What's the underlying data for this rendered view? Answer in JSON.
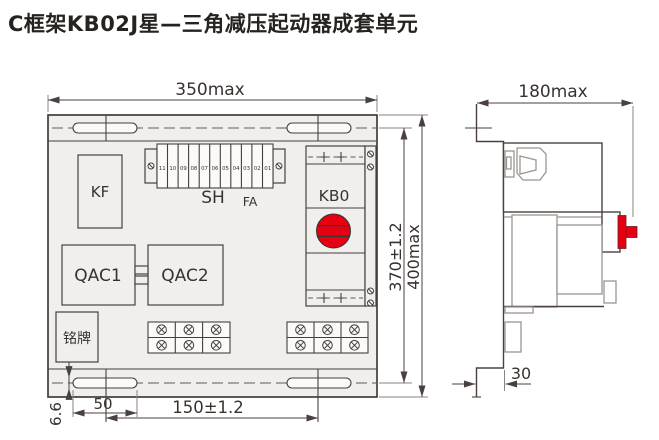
{
  "title": "C框架KB02J星—三角减压起动器成套单元",
  "colors": {
    "accent_red": "#e60012",
    "line_dark": "#4a413f",
    "line_gray": "#9b9490",
    "panel_fill": "#f0efee"
  },
  "front_view": {
    "dims": {
      "width": "350max",
      "height_mount": "370±1.2",
      "height_overall": "400max",
      "slot_width": "6.6",
      "slot_length": "50",
      "slot_spacing": "150±1.2"
    },
    "labels": {
      "kf": "KF",
      "sh": "SH",
      "fa": "FA",
      "kb0": "KB0",
      "qac1": "QAC1",
      "qac2": "QAC2",
      "nameplate": "铭牌"
    },
    "terminal_numbers": [
      "11",
      "10",
      "09",
      "08",
      "07",
      "06",
      "05",
      "04",
      "03",
      "02",
      "01"
    ]
  },
  "side_view": {
    "dims": {
      "depth": "180max",
      "flange_offset": "30"
    }
  }
}
